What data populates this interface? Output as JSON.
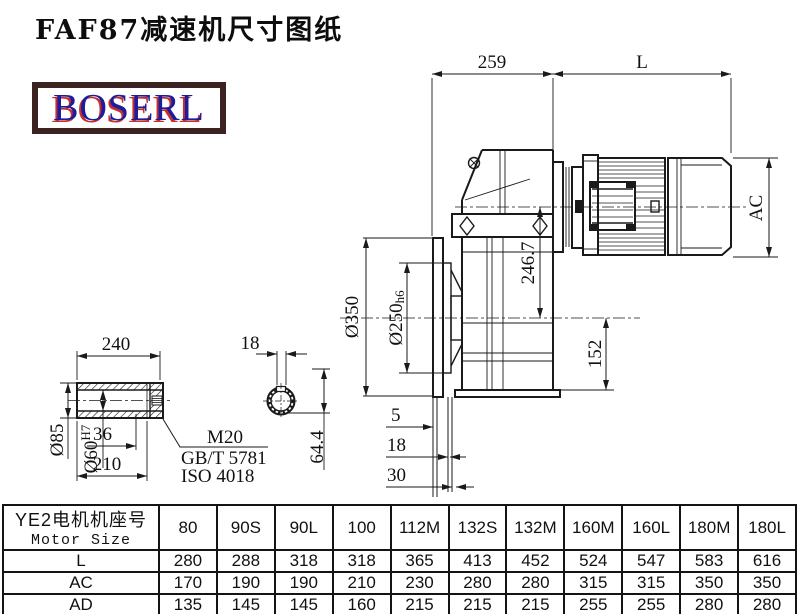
{
  "title": "FAF87减速机尺寸图纸",
  "logo": {
    "text": "BOSERL"
  },
  "colors": {
    "logo_text": "#1c1c9c",
    "logo_shadow": "#c43030",
    "logo_border": "#3d2222",
    "line": "#1a1a1a"
  },
  "main_view": {
    "dim_width_gearbox": "259",
    "dim_motor_length": "L",
    "dim_motor_diameter": "AC",
    "dim_axis_distance": "246.7",
    "dim_flange_od": "Ø350",
    "dim_flange_spigot": "Ø250",
    "dim_flange_spigot_tol": "h6",
    "dim_axis_to_bottom": "152",
    "dim_step1": "5",
    "dim_step2": "18",
    "dim_step3": "30"
  },
  "shaft_view": {
    "dim_length": "240",
    "dim_keyway_width": "18",
    "dim_od": "Ø85",
    "dim_bore": "Ø60",
    "dim_bore_tol": "H7",
    "dim_step": "36",
    "dim_usable_length": "210",
    "thread_label": "M20",
    "standard_gb": "GB/T 5781",
    "standard_iso": "ISO 4018",
    "dim_keyway_depth": "64.4"
  },
  "table": {
    "header_line1": "YE2电机机座号",
    "header_line2": "Motor Size",
    "columns": [
      "80",
      "90S",
      "90L",
      "100",
      "112M",
      "132S",
      "132M",
      "160M",
      "160L",
      "180M",
      "180L"
    ],
    "rows": [
      {
        "label": "L",
        "values": [
          "280",
          "288",
          "318",
          "318",
          "365",
          "413",
          "452",
          "524",
          "547",
          "583",
          "616"
        ]
      },
      {
        "label": "AC",
        "values": [
          "170",
          "190",
          "190",
          "210",
          "230",
          "280",
          "280",
          "315",
          "315",
          "350",
          "350"
        ]
      },
      {
        "label": "AD",
        "values": [
          "135",
          "145",
          "145",
          "160",
          "215",
          "215",
          "215",
          "255",
          "255",
          "280",
          "280"
        ]
      }
    ]
  }
}
